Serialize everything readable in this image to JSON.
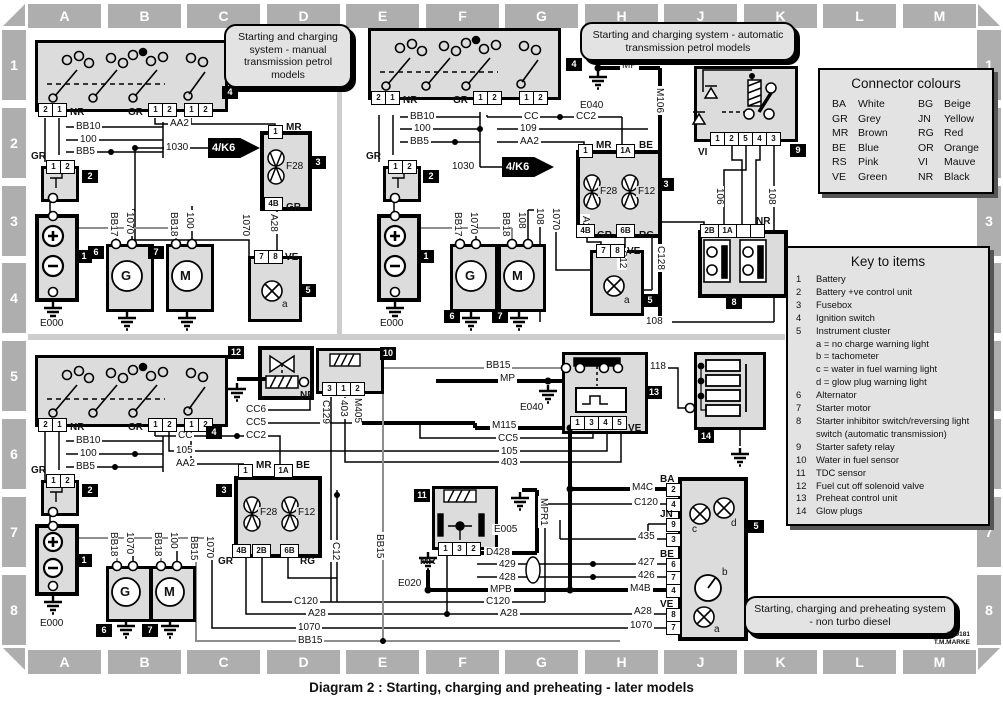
{
  "page": {
    "caption": "Diagram 2 : Starting, charging and preheating - later models",
    "ref_line1": "H29181",
    "ref_line2": "T.M.MARKE"
  },
  "grid": {
    "cols": [
      "A",
      "B",
      "C",
      "D",
      "E",
      "F",
      "G",
      "H",
      "J",
      "K",
      "L",
      "M"
    ],
    "rows": [
      "1",
      "2",
      "3",
      "4",
      "5",
      "6",
      "7",
      "8"
    ]
  },
  "callouts": {
    "manual": "Starting and charging system - manual transmission petrol models",
    "auto": "Starting and charging system - automatic transmission petrol models",
    "diesel": "Starting, charging and preheating system - non turbo diesel"
  },
  "connector_colours": {
    "title": "Connector colours",
    "entries": [
      {
        "code": "BA",
        "name": "White"
      },
      {
        "code": "BG",
        "name": "Beige"
      },
      {
        "code": "GR",
        "name": "Grey"
      },
      {
        "code": "JN",
        "name": "Yellow"
      },
      {
        "code": "MR",
        "name": "Brown"
      },
      {
        "code": "RG",
        "name": "Red"
      },
      {
        "code": "BE",
        "name": "Blue"
      },
      {
        "code": "OR",
        "name": "Orange"
      },
      {
        "code": "RS",
        "name": "Pink"
      },
      {
        "code": "VI",
        "name": "Mauve"
      },
      {
        "code": "VE",
        "name": "Green"
      },
      {
        "code": "NR",
        "name": "Black"
      }
    ]
  },
  "key_to_items": {
    "title": "Key to items",
    "items": [
      {
        "num": "1",
        "label": "Battery"
      },
      {
        "num": "2",
        "label": "Battery +ve control unit"
      },
      {
        "num": "3",
        "label": "Fusebox"
      },
      {
        "num": "4",
        "label": "Ignition switch"
      },
      {
        "num": "5",
        "label": "Instrument cluster"
      },
      {
        "num": "",
        "label": "a = no charge warning light"
      },
      {
        "num": "",
        "label": "b = tachometer"
      },
      {
        "num": "",
        "label": "c = water in fuel warning light"
      },
      {
        "num": "",
        "label": "d = glow plug warning light"
      },
      {
        "num": "6",
        "label": "Alternator"
      },
      {
        "num": "7",
        "label": "Starter motor"
      },
      {
        "num": "8",
        "label": "Starter inhibitor switch/reversing light switch (automatic transmission)"
      },
      {
        "num": "9",
        "label": "Starter safety relay"
      },
      {
        "num": "10",
        "label": "Water in fuel sensor"
      },
      {
        "num": "11",
        "label": "TDC sensor"
      },
      {
        "num": "12",
        "label": "Fuel cut off solenoid valve"
      },
      {
        "num": "13",
        "label": "Preheat control unit"
      },
      {
        "num": "14",
        "label": "Glow plugs"
      }
    ]
  },
  "labels": {
    "p1": "1",
    "p2": "2",
    "p3": "3",
    "p4": "4",
    "p5": "5",
    "p6": "6",
    "p7": "7",
    "p8": "8",
    "p9": "9",
    "p1a": "1A",
    "p2b": "2B",
    "p4b": "4B",
    "p6b": "6B",
    "t1": "1",
    "t2": "2",
    "t3": "3",
    "t4": "4",
    "t5": "5",
    "t6": "6",
    "t7": "7",
    "t8": "8",
    "t9": "9",
    "t10": "10",
    "t11": "11",
    "t12": "12",
    "t13": "13",
    "t14": "14",
    "nr": "NR",
    "gr": "GR",
    "mr": "MR",
    "be": "BE",
    "ve": "VE",
    "vi": "VI",
    "rg": "RG",
    "ba": "BA",
    "jn": "JN",
    "bb5": "BB5",
    "bb10": "BB10",
    "bb15": "BB15",
    "bb17": "BB17",
    "bb18": "BB18",
    "w100": "100",
    "w105": "105",
    "w106": "106",
    "w108": "108",
    "w109": "109",
    "w118": "118",
    "w403": "403",
    "w426": "426",
    "w427": "427",
    "w428": "428",
    "w429": "429",
    "w435": "435",
    "w1030": "1030",
    "w1070": "1070",
    "aa2": "AA2",
    "cc": "CC",
    "cc2": "CC2",
    "cc5": "CC5",
    "cc6": "CC6",
    "a28": "A28",
    "c12": "C12",
    "c120": "C120",
    "c128": "C128",
    "c129": "C129",
    "d428": "D428",
    "m4b": "M4B",
    "m4c": "M4C",
    "m106": "M106",
    "m115": "M115",
    "m405": "M405",
    "mp": "MP",
    "mpb": "MPB",
    "mpr1": "MPR1",
    "e000": "E000",
    "e005": "E005",
    "e020": "E020",
    "e040": "E040",
    "f12": "F12",
    "f28": "F28",
    "k6": "4/K6",
    "g": "G",
    "m": "M",
    "a": "a",
    "b": "b",
    "c": "c",
    "d": "d",
    "plus": "+",
    "minus": "−"
  }
}
